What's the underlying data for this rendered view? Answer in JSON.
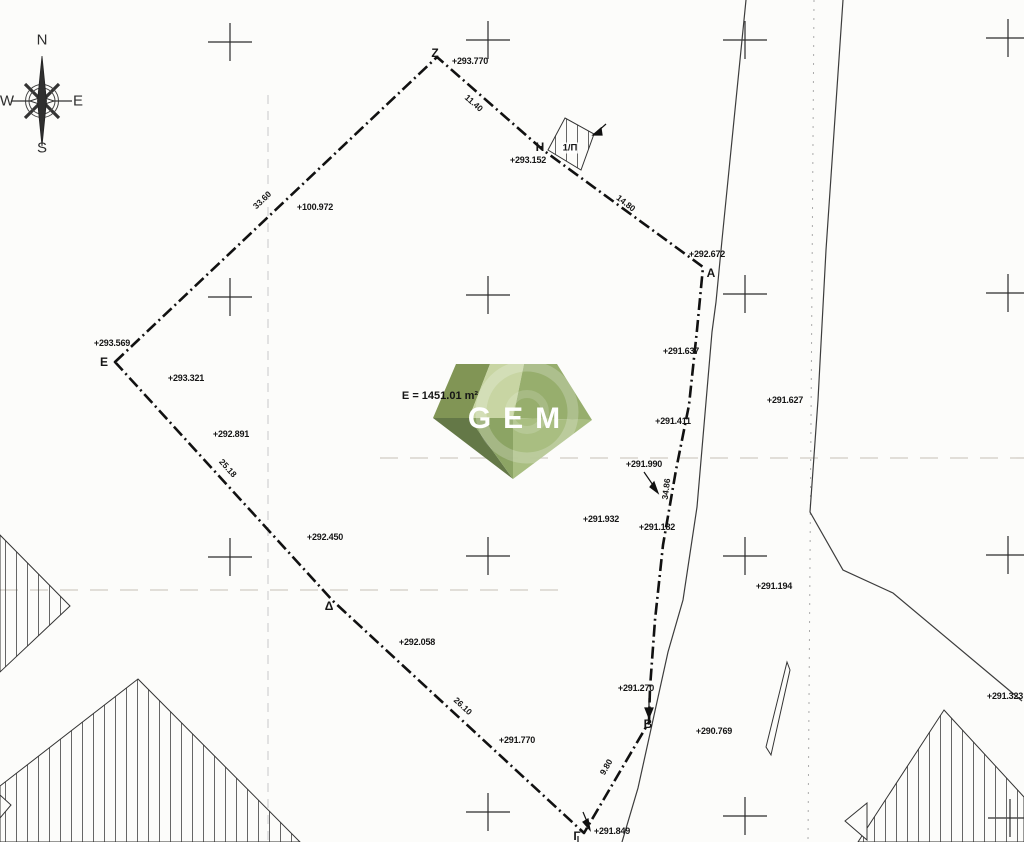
{
  "document": {
    "type": "topographic-survey-plan"
  },
  "compass": {
    "north": "N",
    "east": "E",
    "south": "S",
    "west": "W"
  },
  "parcel": {
    "area_label": "E = 1451.01 m²",
    "building_label": "1/Π",
    "vertex_names": [
      "Z",
      "H",
      "A",
      "B",
      "Γ",
      "Δ",
      "E"
    ]
  },
  "watermark": {
    "text": "GEM"
  },
  "colors": {
    "gem_f1": "#7c914f",
    "gem_f2": "#c6d4a0",
    "gem_f3": "#93ab68",
    "gem_f4": "#5e7340",
    "gem_f5": "#88a15e",
    "gem_f6": "#a6bc7d",
    "line": "#161616"
  },
  "labels": [
    {
      "n": "compass-n",
      "t": "N",
      "x": 42,
      "y": 40,
      "c": "compass"
    },
    {
      "n": "compass-w",
      "t": "W",
      "x": 7,
      "y": 101,
      "c": "compass"
    },
    {
      "n": "compass-e",
      "t": "E",
      "x": 78,
      "y": 101,
      "c": "compass"
    },
    {
      "n": "compass-s",
      "t": "S",
      "x": 42,
      "y": 148,
      "c": "compass"
    },
    {
      "n": "point-label-z",
      "t": "Z",
      "x": 435,
      "y": 53,
      "c": "pt"
    },
    {
      "n": "elevation-label",
      "t": "+293.770",
      "x": 470,
      "y": 61,
      "c": "el"
    },
    {
      "n": "point-label-h",
      "t": "H",
      "x": 540,
      "y": 147,
      "c": "pt"
    },
    {
      "n": "elevation-label",
      "t": "+293.152",
      "x": 528,
      "y": 160,
      "c": "el"
    },
    {
      "n": "building-label",
      "t": "1/Π",
      "x": 570,
      "y": 148,
      "c": "bldg"
    },
    {
      "n": "distance-label",
      "t": "11.40",
      "x": 474,
      "y": 103,
      "r": 41,
      "c": "dist"
    },
    {
      "n": "distance-label",
      "t": "14.80",
      "x": 626,
      "y": 203,
      "r": 38,
      "c": "dist"
    },
    {
      "n": "elevation-label",
      "t": "+292.672",
      "x": 707,
      "y": 254,
      "c": "el"
    },
    {
      "n": "point-label-a",
      "t": "A",
      "x": 711,
      "y": 273,
      "c": "pt"
    },
    {
      "n": "distance-label",
      "t": "33.60",
      "x": 262,
      "y": 200,
      "r": -44,
      "c": "dist"
    },
    {
      "n": "elevation-label",
      "t": "+100.972",
      "x": 315,
      "y": 207,
      "c": "el"
    },
    {
      "n": "elevation-label",
      "t": "+293.569",
      "x": 112,
      "y": 343,
      "c": "el"
    },
    {
      "n": "point-label-e",
      "t": "E",
      "x": 104,
      "y": 362,
      "c": "pt"
    },
    {
      "n": "elevation-label",
      "t": "+293.321",
      "x": 186,
      "y": 378,
      "c": "el"
    },
    {
      "n": "elevation-label",
      "t": "+292.891",
      "x": 231,
      "y": 434,
      "c": "el"
    },
    {
      "n": "distance-label",
      "t": "25.18",
      "x": 228,
      "y": 468,
      "r": 48,
      "c": "dist"
    },
    {
      "n": "elevation-label",
      "t": "+292.450",
      "x": 325,
      "y": 537,
      "c": "el"
    },
    {
      "n": "point-label-delta",
      "t": "Δ",
      "x": 329,
      "y": 606,
      "c": "pt"
    },
    {
      "n": "elevation-label",
      "t": "+292.058",
      "x": 417,
      "y": 642,
      "c": "el"
    },
    {
      "n": "distance-label",
      "t": "26.10",
      "x": 463,
      "y": 706,
      "r": 43,
      "c": "dist"
    },
    {
      "n": "elevation-label",
      "t": "+291.770",
      "x": 517,
      "y": 740,
      "c": "el"
    },
    {
      "n": "elevation-label",
      "t": "+291.637",
      "x": 681,
      "y": 351,
      "c": "el"
    },
    {
      "n": "elevation-label",
      "t": "+291.627",
      "x": 785,
      "y": 400,
      "c": "el"
    },
    {
      "n": "elevation-label",
      "t": "+291.411",
      "x": 673,
      "y": 421,
      "c": "el"
    },
    {
      "n": "elevation-label",
      "t": "+291.990",
      "x": 644,
      "y": 464,
      "c": "el"
    },
    {
      "n": "distance-label",
      "t": "34.86",
      "x": 666,
      "y": 489,
      "r": -83,
      "c": "dist"
    },
    {
      "n": "elevation-label",
      "t": "+291.932",
      "x": 601,
      "y": 519,
      "c": "el"
    },
    {
      "n": "elevation-label",
      "t": "+291.182",
      "x": 657,
      "y": 527,
      "c": "el"
    },
    {
      "n": "elevation-label",
      "t": "+291.194",
      "x": 774,
      "y": 586,
      "c": "el"
    },
    {
      "n": "elevation-label",
      "t": "+291.270",
      "x": 636,
      "y": 688,
      "c": "el"
    },
    {
      "n": "point-label-b",
      "t": "B",
      "x": 648,
      "y": 724,
      "c": "pt"
    },
    {
      "n": "elevation-label",
      "t": "+290.769",
      "x": 714,
      "y": 731,
      "c": "el"
    },
    {
      "n": "distance-label",
      "t": "9.80",
      "x": 606,
      "y": 767,
      "r": -60,
      "c": "dist"
    },
    {
      "n": "point-label-gamma",
      "t": "Γ",
      "x": 577,
      "y": 836,
      "c": "pt"
    },
    {
      "n": "elevation-label",
      "t": "+291.849",
      "x": 612,
      "y": 831,
      "c": "el"
    },
    {
      "n": "elevation-label",
      "t": "+291.323",
      "x": 1005,
      "y": 696,
      "c": "el"
    },
    {
      "n": "parcel-area-label",
      "t": "E = 1451.01 m²",
      "x": 440,
      "y": 396,
      "c": "area"
    },
    {
      "n": "watermark-text",
      "t": "GEM",
      "x": 514,
      "y": 419,
      "c": "gemtxt"
    }
  ]
}
